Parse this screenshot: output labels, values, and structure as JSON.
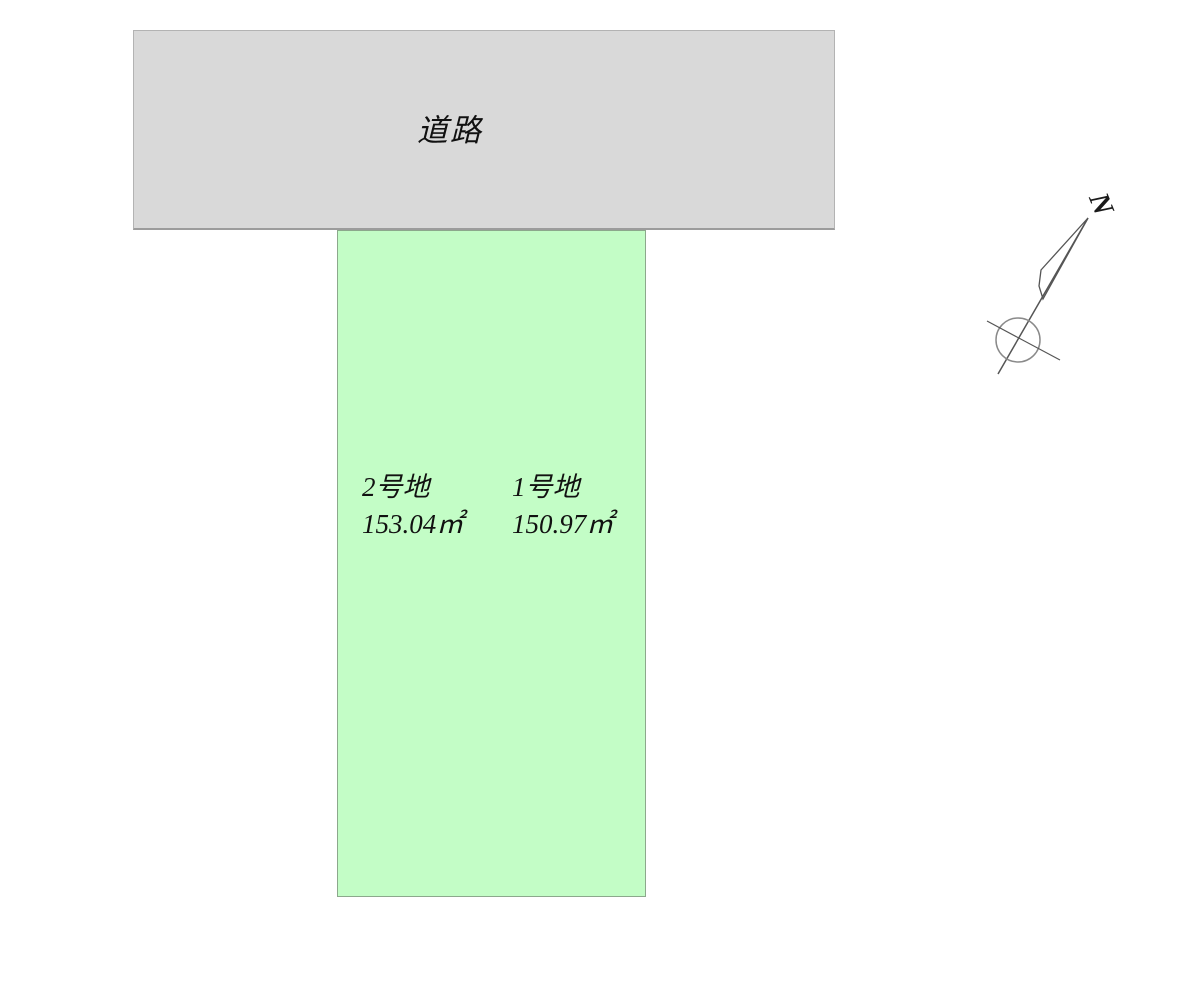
{
  "road": {
    "label": "道路",
    "fill": "#d9d9d9"
  },
  "lots": [
    {
      "name": "2号地",
      "area": "153.04㎡",
      "fill": "#c3fdc6",
      "border": "#8ca88c"
    },
    {
      "name": "1号地",
      "area": "150.97㎡",
      "fill": "#c3fdc6",
      "border": "#8ca88c"
    }
  ],
  "compass": {
    "north_label": "N",
    "line_color": "#555555",
    "circle_color": "#8a8a8a"
  }
}
